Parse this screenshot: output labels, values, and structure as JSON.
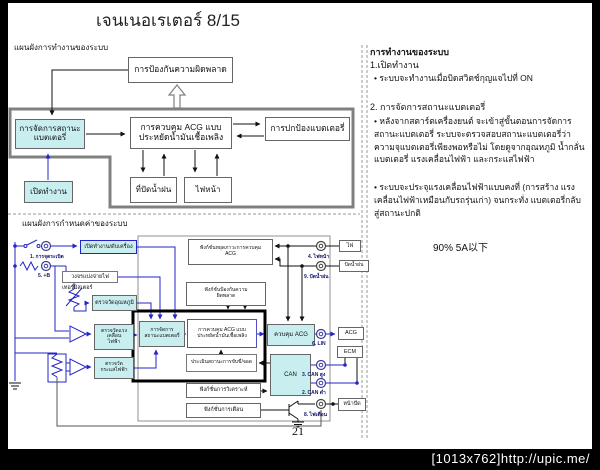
{
  "slide": {
    "title": "เจนเนอเรเตอร์ 8/15",
    "page_number": "21"
  },
  "watermark": "[1013x762]http://upic.me/",
  "flow_diagram": {
    "label": "แผนผังการทำงานของระบบ",
    "error_prevention": "การป้องกันความผิดพลาด",
    "battery_management": "การจัดการสถานะ\nแบตเตอรี่",
    "acg_control": "การควบคุม ACG แบบ\nประหยัดน้ำมันเชื้อเพลิง",
    "battery_protection": "การปกป้องแบตเตอรี่",
    "wiper": "ที่ปัดน้ำฝน",
    "headlight": "ไฟหน้า",
    "power_on": "เปิดทำงาน"
  },
  "description_panel": {
    "heading": "การทำงานของระบบ",
    "section1_title": "1.เปิดทำงาน",
    "section1_bullet": "• ระบบจะทำงานเมื่อบิดสวิตช์กุญแจไปที่ ON",
    "section2_title": "2. การจัดการสถานะแบตเตอรี่",
    "section2_bullet1": "• หลังจากสตาร์ตเครื่องยนต์ จะเข้าสู่ขั้นตอนการจัดการ สถานะแบตเตอรี่ ระบบจะตรวจสอบสถานะแบตเตอรี่ว่า ความจุแบตเตอรี่เพียงพอหรือไม่ โดยดูจากอุณหภูมิ น้ำกลั่นแบตเตอรี่ แรงเคลื่อนไฟฟ้า และกระแสไฟฟ้า",
    "section2_bullet2": "• ระบบจะประจุแรงเคลื่อนไฟฟ้าแบบคงที่ (การสร้าง แรงเคลื่อนไฟฟ้าเหมือนกับรถรุ่นเก่า) จนกระทั่ง แบตเตอรี่กลับสู่สถานะปกติ",
    "note": "90%  5A以下"
  },
  "config_diagram": {
    "label": "แผนผังการกำหนดค่าของระบบ",
    "pins": {
      "ignition": "1. การจุดระเบิด",
      "plus_b": "5. +B",
      "headlight": "4. ไฟหน้า",
      "wiper": "9. ปัดน้ำฝน",
      "lin": "6. LIN",
      "can_high": "3. CAN สูง",
      "can_low": "2. CAN ต่ำ",
      "warning_lamp": "8. ไฟเตือน"
    },
    "blocks": {
      "start_stop": "เปิดทำงาน/ดับเครื่อง",
      "power_divider": "วงจรแบ่งจ่ายไฟ",
      "thermistor": "เทอร์มิสเตอร์",
      "temp_measure": "ตรวจวัดอุณหภูมิ",
      "volt_measure": "ตรวจวัดแรง\nเคลื่อน\nไฟฟ้า",
      "current_measure": "ตรวจวัด\nกระแสไฟฟ้า",
      "battery_management": "การจัดการ\nสถานะแบตเตอรี่",
      "acg_fuel_control": "การควบคุม ACG แบบ\nประหยัดน้ำมันเชื้อเพลิง",
      "driving_eval": "ประเมินสถานะการขับขี่/จอด",
      "acg_ctrl": "ควบคุม ACG",
      "can": "CAN",
      "stop_function": "ฟังก์ชั่นหยุดภาวะการควบคุม\nACG",
      "error_function": "ฟังก์ชั่นป้องกันความ\nผิดพลาด",
      "diagnosis_function": "ฟังก์ชั่นการวิเคราะห์",
      "warning_function": "ฟังก์ชั่นการเตือน"
    },
    "devices": {
      "light": "ไฟ",
      "wiper": "ปัดน้ำฝน",
      "acg": "ACG",
      "ecm": "ECM",
      "panel": "หน้าปัด"
    }
  },
  "colors": {
    "cyan_fill": "#C8EEF0",
    "blue_wire": "#2424C8",
    "frame_gray": "#808080"
  }
}
